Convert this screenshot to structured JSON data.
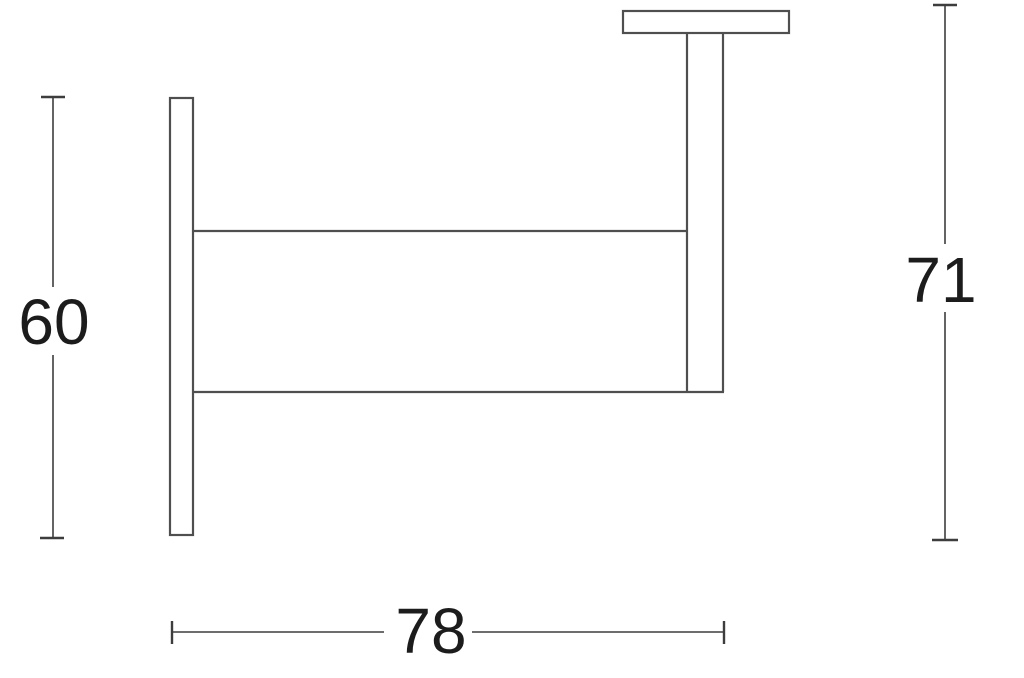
{
  "colors": {
    "background": "#ffffff",
    "line": "#4f4f4f",
    "dim_line": "#3d3d3d",
    "text": "#1c1c1c"
  },
  "drawing": {
    "name": "wall-bracket-dimension-drawing",
    "dimensions": {
      "plate_height": {
        "label": "60"
      },
      "overall_height": {
        "label": "71"
      },
      "overall_width": {
        "label": "78"
      }
    }
  }
}
